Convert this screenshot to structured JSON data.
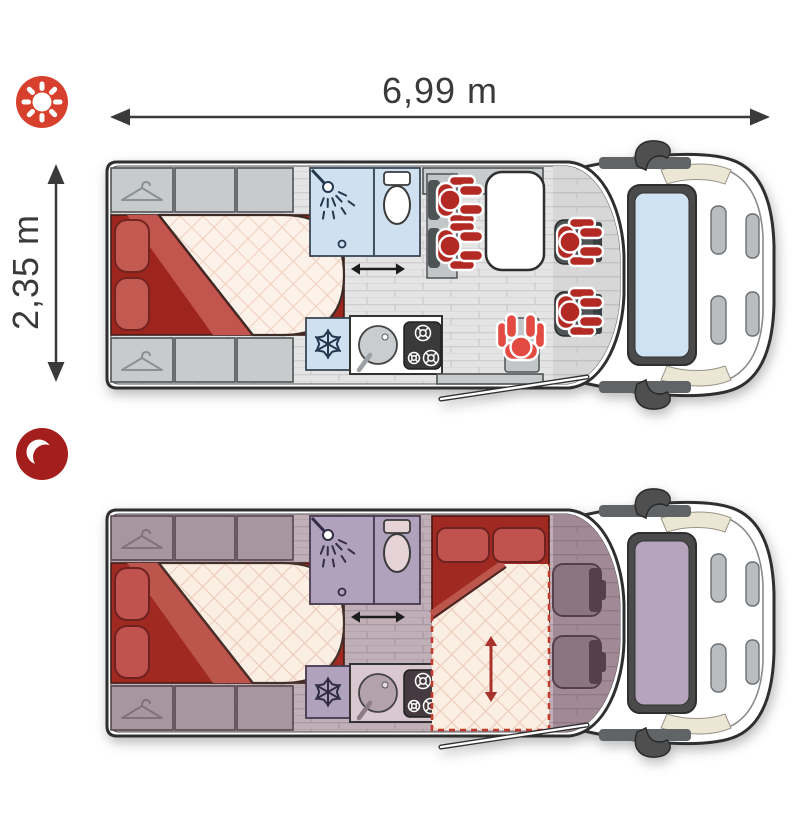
{
  "dimensions": {
    "length": "6,99 m",
    "width": "2,35 m"
  },
  "modes": {
    "day": {
      "icon": "sun-icon",
      "occupants": 5
    },
    "night": {
      "icon": "moon-icon",
      "occupants": 0
    }
  },
  "colors": {
    "day_accent": "#d6402c",
    "night_accent": "#a51e1e",
    "outline": "#2f2f2f",
    "person_red": "#b22a23",
    "person_light_red": "#e34b42",
    "bed_blanket_red": "#9e241e",
    "pillow_red": "#c25a52",
    "mattress_cream": "#fdf2e9",
    "fixture_blue": "#cfe1f1",
    "day_cabinet_gray": "#c7cbcc",
    "night_cabinet_mauve": "#a8969f",
    "windshield_day": "#cfe2f2",
    "windshield_night": "#b6a4bd",
    "dimension_ink": "#3a3a3a"
  },
  "plans": {
    "day": {
      "features": [
        "wardrobe",
        "double-bed",
        "shower",
        "toilet",
        "fridge",
        "sink",
        "hob",
        "dinette-bench",
        "dinette-table",
        "swivel-cab-seats",
        "side-seat",
        "entry-door"
      ]
    },
    "night": {
      "features": [
        "wardrobe",
        "double-bed",
        "shower",
        "toilet",
        "fridge",
        "sink",
        "hob",
        "converted-dinette-bed",
        "bed-extension-arrow",
        "empty-cab-seats",
        "entry-door"
      ]
    }
  }
}
